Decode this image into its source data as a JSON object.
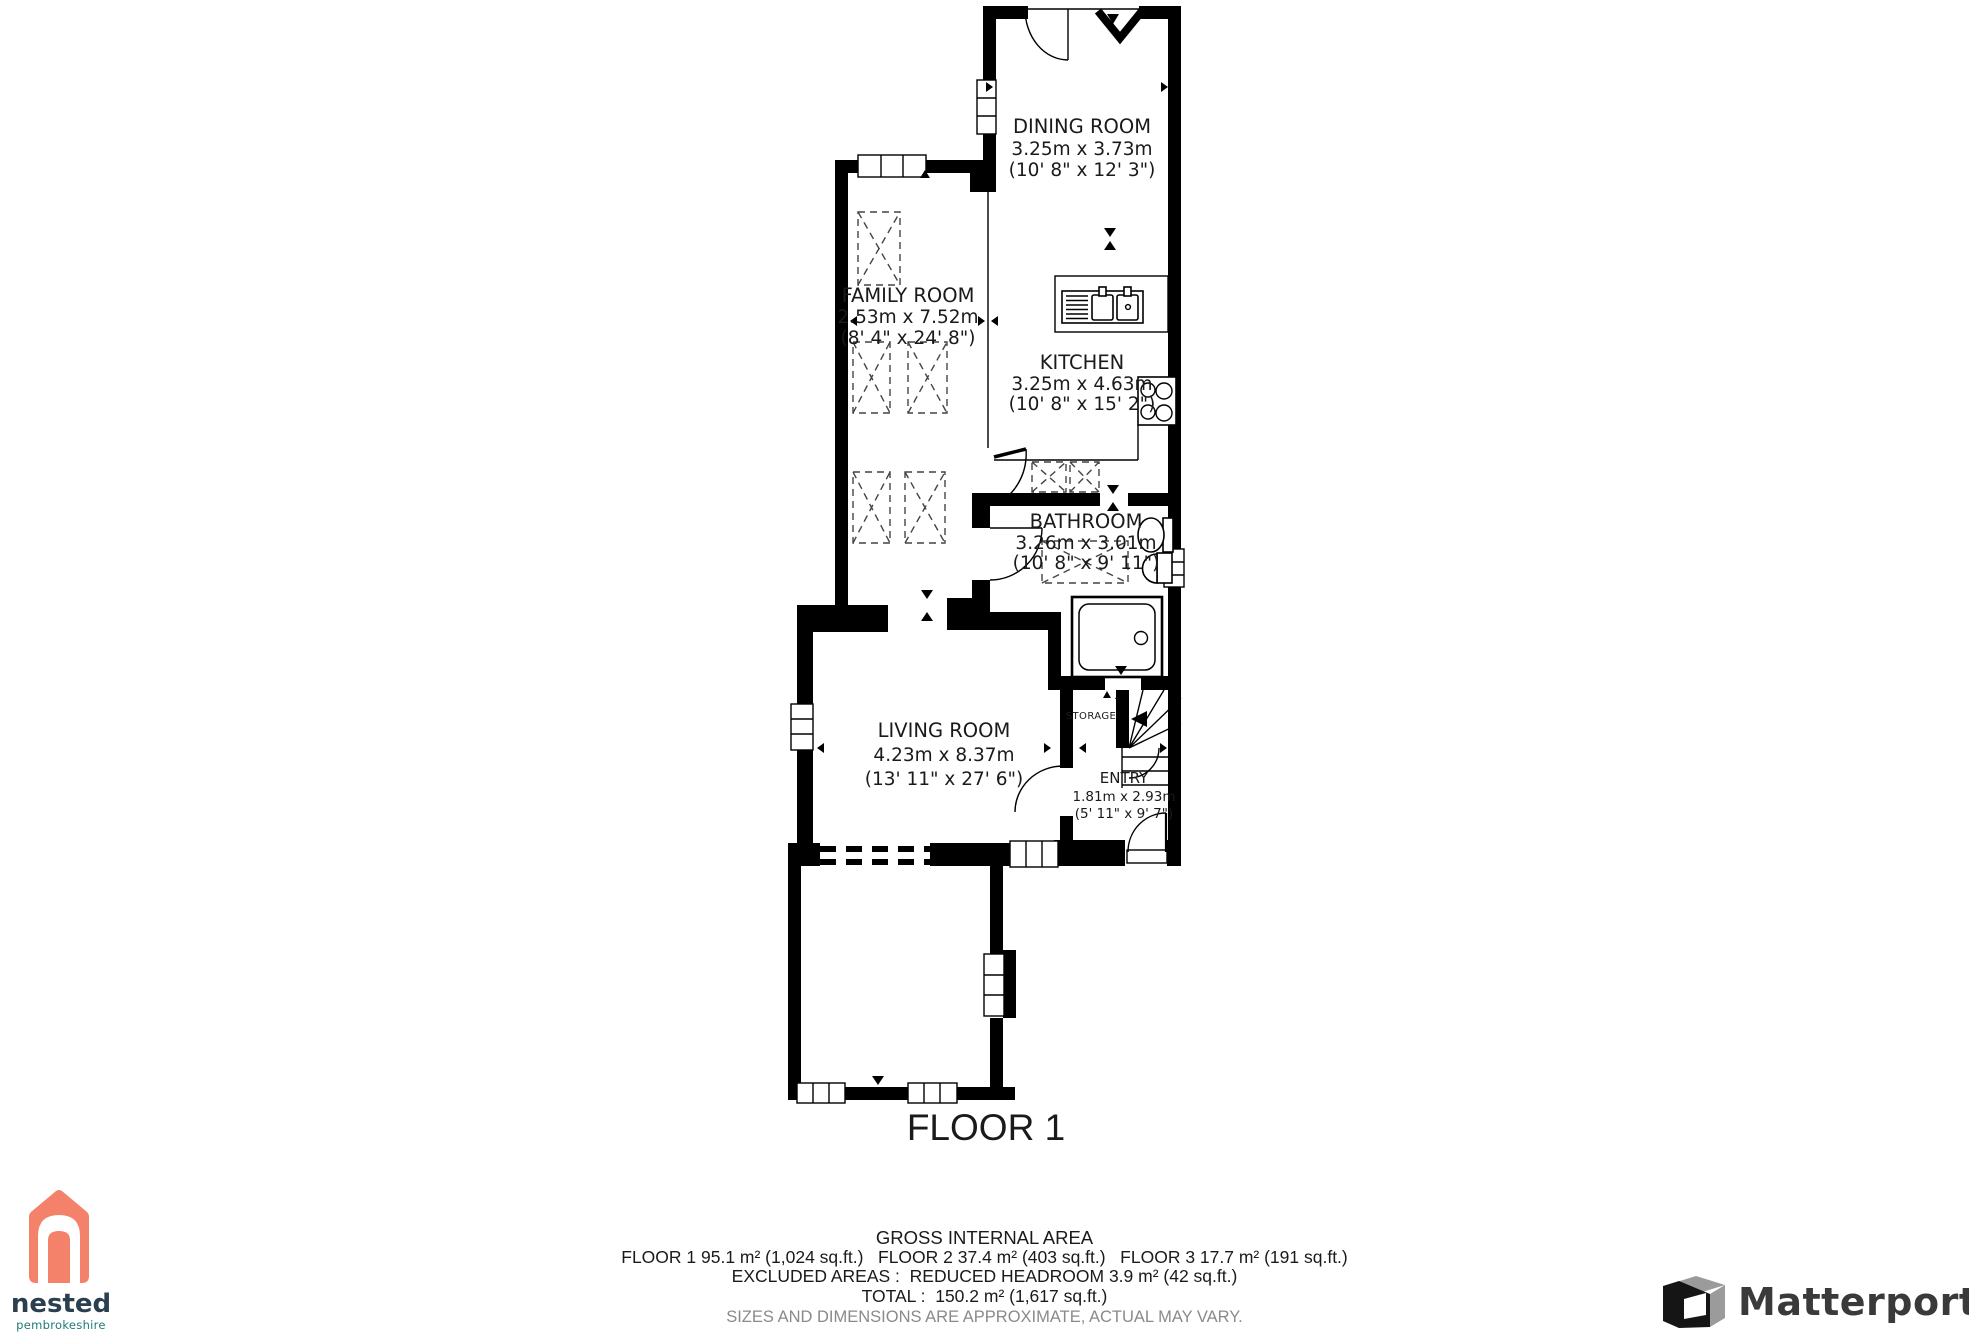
{
  "document": {
    "title": "Floor plan - Floor 1"
  },
  "floor_label": "FLOOR 1",
  "rooms": [
    {
      "id": "dining",
      "name": "DINING ROOM",
      "metric": "3.25m x 3.73m",
      "imperial": "(10' 8\" x 12' 3\")"
    },
    {
      "id": "family",
      "name": "FAMILY ROOM",
      "metric": "2.53m x 7.52m",
      "imperial": "(8' 4\" x 24' 8\")"
    },
    {
      "id": "kitchen",
      "name": "KITCHEN",
      "metric": "3.25m x 4.63m",
      "imperial": "(10' 8\" x 15' 2\")"
    },
    {
      "id": "bathroom",
      "name": "BATHROOM",
      "metric": "3.26m x 3.01m",
      "imperial": "(10' 8\" x 9' 11\")"
    },
    {
      "id": "living",
      "name": "LIVING ROOM",
      "metric": "4.23m x 8.37m",
      "imperial": "(13' 11\" x 27' 6\")"
    },
    {
      "id": "entry",
      "name": "ENTRY",
      "metric": "1.81m x 2.93m",
      "imperial": "(5' 11\" x 9' 7\")"
    },
    {
      "id": "storage",
      "name": "STORAGE"
    }
  ],
  "footer": {
    "heading": "GROSS INTERNAL AREA",
    "areas_line": "FLOOR 1 95.1 m² (1,024 sq.ft.)   FLOOR 2 37.4 m² (403 sq.ft.)   FLOOR 3 17.7 m² (191 sq.ft.)",
    "excluded_line": "EXCLUDED AREAS :  REDUCED HEADROOM 3.9 m² (42 sq.ft.)",
    "total_line": "TOTAL :  150.2 m² (1,617 sq.ft.)",
    "disclaimer": "SIZES AND DIMENSIONS ARE APPROXIMATE, ACTUAL MAY VARY."
  },
  "branding": {
    "nested": {
      "name": "nested",
      "region": "pembrokeshire",
      "house_color": "#F4826B",
      "name_color": "#2A4050",
      "region_color": "#1E7B76"
    },
    "matterport": {
      "name": "Matterport",
      "text_color": "#3a3a3a",
      "icon_black": "#151515",
      "icon_gray": "#9B9B9B"
    }
  }
}
